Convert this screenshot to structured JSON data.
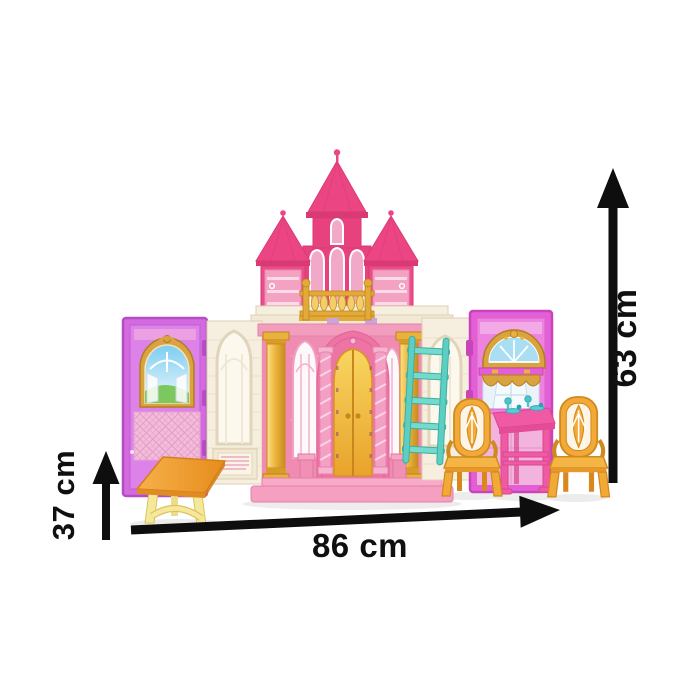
{
  "page": {
    "type": "product dimension illustration",
    "subject": "Fold-out princess castle dollhouse playset with furniture",
    "background": "#ffffff"
  },
  "annotations": {
    "width": {
      "label": "86 cm",
      "orientation": "horizontal",
      "position": "bottom"
    },
    "height": {
      "label": "63 cm",
      "orientation": "vertical",
      "position": "right"
    },
    "depth": {
      "label": "37 cm",
      "orientation": "vertical",
      "position": "left"
    }
  },
  "scene": {
    "items": [
      "pink castle with three spired towers",
      "gold balcony railing",
      "golden arched double doors",
      "two gold columns",
      "teal ladder",
      "purple wing panel with arched scenic window and quilted wall",
      "magenta wing panel with lunette window and curtained window",
      "pink dining table with teal tea set",
      "two yellow dining chairs",
      "yellow trestle side table"
    ]
  },
  "colors": {
    "arrow": "#0e0e0e",
    "label-text": "#101010",
    "deep-pink": "#e7417e",
    "spire-pink": "#ec4584",
    "roof-edge": "#d93a74",
    "tower-side": "#ea4d89",
    "tower-door": "#f3a2c2",
    "tower-door-bar": "#fbd9e7",
    "window-pink": "#f2a9c9",
    "facade-pink": "#f08cb2",
    "facade-top": "#f29cbe",
    "portal-pink": "#ee74a4",
    "twist-pink": "#f4a0c4",
    "door-gold-light": "#f8d660",
    "door-gold-dark": "#e8a32b",
    "door-seam": "#c8861c",
    "gold": "#e8b23c",
    "gold-dark": "#c08320",
    "gold-rail": "#e2ab38",
    "baluster-gold": "#f3cf6a",
    "cream": "#f6efdf",
    "cream-line": "#ddd0b4",
    "cream-window": "#fcf8ee",
    "purple-panel": "#d36ae0",
    "purple-panel-dark": "#b44cc4",
    "purple-inner": "#dc82e9",
    "magenta-panel": "#e45ed5",
    "magenta-panel-dark": "#c944ba",
    "magenta-inner": "#ee82e0",
    "quilt-pink": "#f3bcd9",
    "quilt-line": "#e29cc8",
    "teal": "#5ccfc2",
    "teal-dark": "#3fae9f",
    "teal-light": "#74dacd",
    "chair-yellow": "#f2a938",
    "chair-outline": "#cf8a1d",
    "chair-shade": "#e8982a",
    "hot-pink": "#f05aa4",
    "hot-pink-dark": "#d94590",
    "table-orange": "#f0a235",
    "table-edge": "#d57f1a",
    "leg-yellow": "#f6e89a",
    "leg-yellow-dark": "#dcc25e",
    "sky": "#7ccdf0",
    "grass": "#7cc85e",
    "glass-blue": "#aadef2",
    "lilac": "#cba4dc",
    "platform-pink": "#f59fc1",
    "platform-edge": "#e57fa9",
    "step-pink": "#f7abc8",
    "plaque-line": "#e59ab8"
  }
}
